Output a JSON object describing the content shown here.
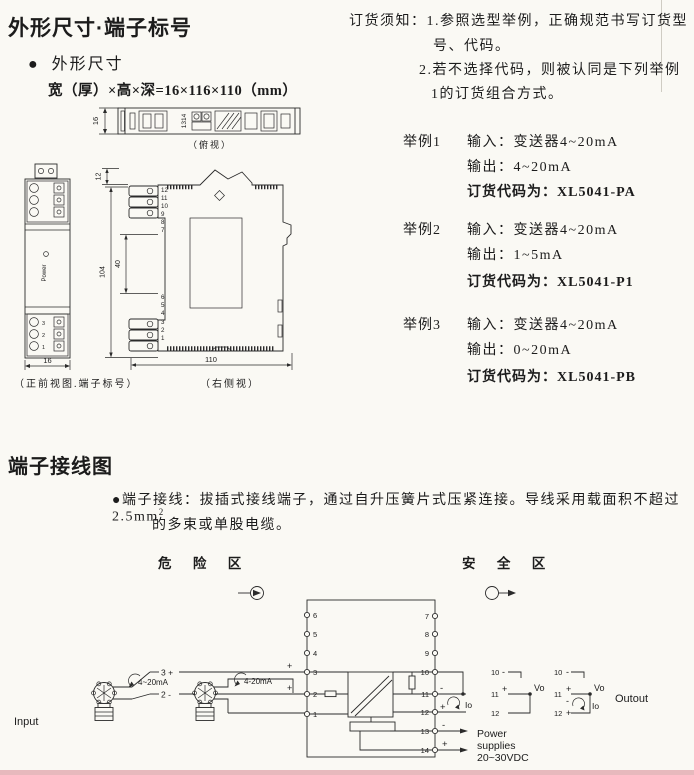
{
  "sec1": {
    "title": "外形尺寸·端子标号",
    "subtitle_bullet": "●",
    "subtitle": "外形尺寸",
    "formula": "宽（厚）×高×深=16×116×110（mm）",
    "cap_top": "（俯视）",
    "cap_front": "（正前视图.端子标号）",
    "cap_side": "（右侧视）",
    "dim_top_16": "16",
    "dim_front_16": "16",
    "dim_12": "12",
    "dim_104": "104",
    "dim_40": "40",
    "dim_110": "110",
    "topview_terms": "1314",
    "power_led": "Power",
    "front_terms": [
      "3",
      "2",
      "1"
    ],
    "side_terms_top": [
      "12",
      "11",
      "10",
      "9",
      "8",
      "7"
    ],
    "side_terms_bot": [
      "6",
      "5",
      "4",
      "3",
      "2",
      "1"
    ]
  },
  "order": {
    "notice_l1": "订货须知：1.参照选型举例，正确规范书写订货型",
    "notice_l2": "号、代码。",
    "notice_l3": "2.若不选择代码，则被认同是下列举例",
    "notice_l4": "1的订货组合方式。",
    "examples": [
      {
        "label": "举例1",
        "input": "输入：变送器4~20mA",
        "output": "输出：4~20mA",
        "code": "订货代码为：XL5041-PA"
      },
      {
        "label": "举例2",
        "input": "输入：变送器4~20mA",
        "output": "输出：1~5mA",
        "code": "订货代码为：XL5041-P1"
      },
      {
        "label": "举例3",
        "input": "输入：变送器4~20mA",
        "output": "输出：0~20mA",
        "code": "订货代码为：XL5041-PB"
      }
    ]
  },
  "sec2": {
    "title": "端子接线图",
    "note_bullet": "●",
    "note_l1": "端子接线：拔插式接线端子，通过自升压簧片式压紧连接。导线采用载面积不超过2.5mm",
    "note_sup": "2",
    "note_l2": "的多束或单股电缆。"
  },
  "wiring": {
    "zone_hazard": "危 险 区",
    "zone_safe": "安 全 区",
    "input": "Input",
    "output": "Outout",
    "loop1": "4~20mA",
    "loop2": "4-20mA",
    "io": "Io",
    "vo": "Vo",
    "plus": "+",
    "minus": "-",
    "lbl_3": "3 +",
    "lbl_2": "2 -",
    "left_terms": [
      "6",
      "5",
      "4",
      "3",
      "2",
      "1"
    ],
    "right_terms": [
      "7",
      "8",
      "9",
      "10",
      "11",
      "12",
      "13",
      "14"
    ],
    "power_l1": "Power",
    "power_l2": "supplies",
    "power_l3": "20~30VDC"
  }
}
